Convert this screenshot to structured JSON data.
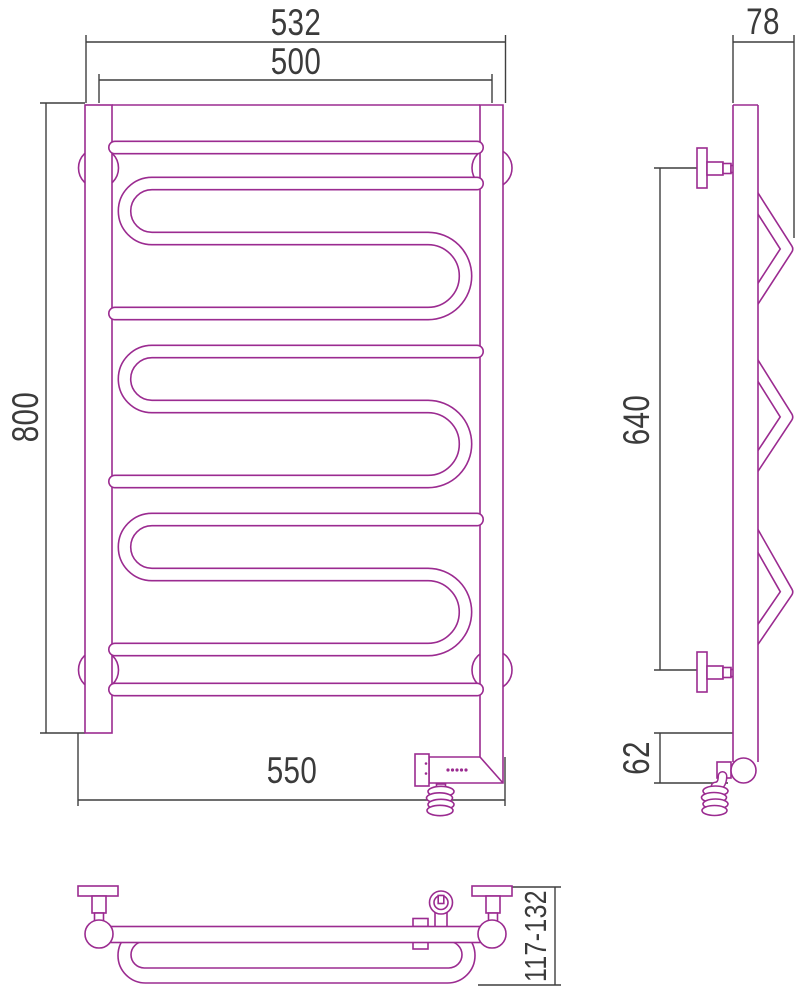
{
  "document": {
    "type": "technical dimensional drawing",
    "subject": "heated towel rail with electric heating element, three orthographic views"
  },
  "dimensions": {
    "front": {
      "overall_width_top": "532",
      "rail_center_width": "500",
      "height": "800",
      "bottom_width": "550"
    },
    "side": {
      "depth": "78",
      "bracket_spacing": "640",
      "bottom_offset": "62"
    },
    "bottom": {
      "wall_clearance": "117-132"
    }
  },
  "colors": {
    "outline": "#9b2b90",
    "dimension": "#3f3f3f",
    "text": "#3b3b3b",
    "background": "#ffffff"
  }
}
